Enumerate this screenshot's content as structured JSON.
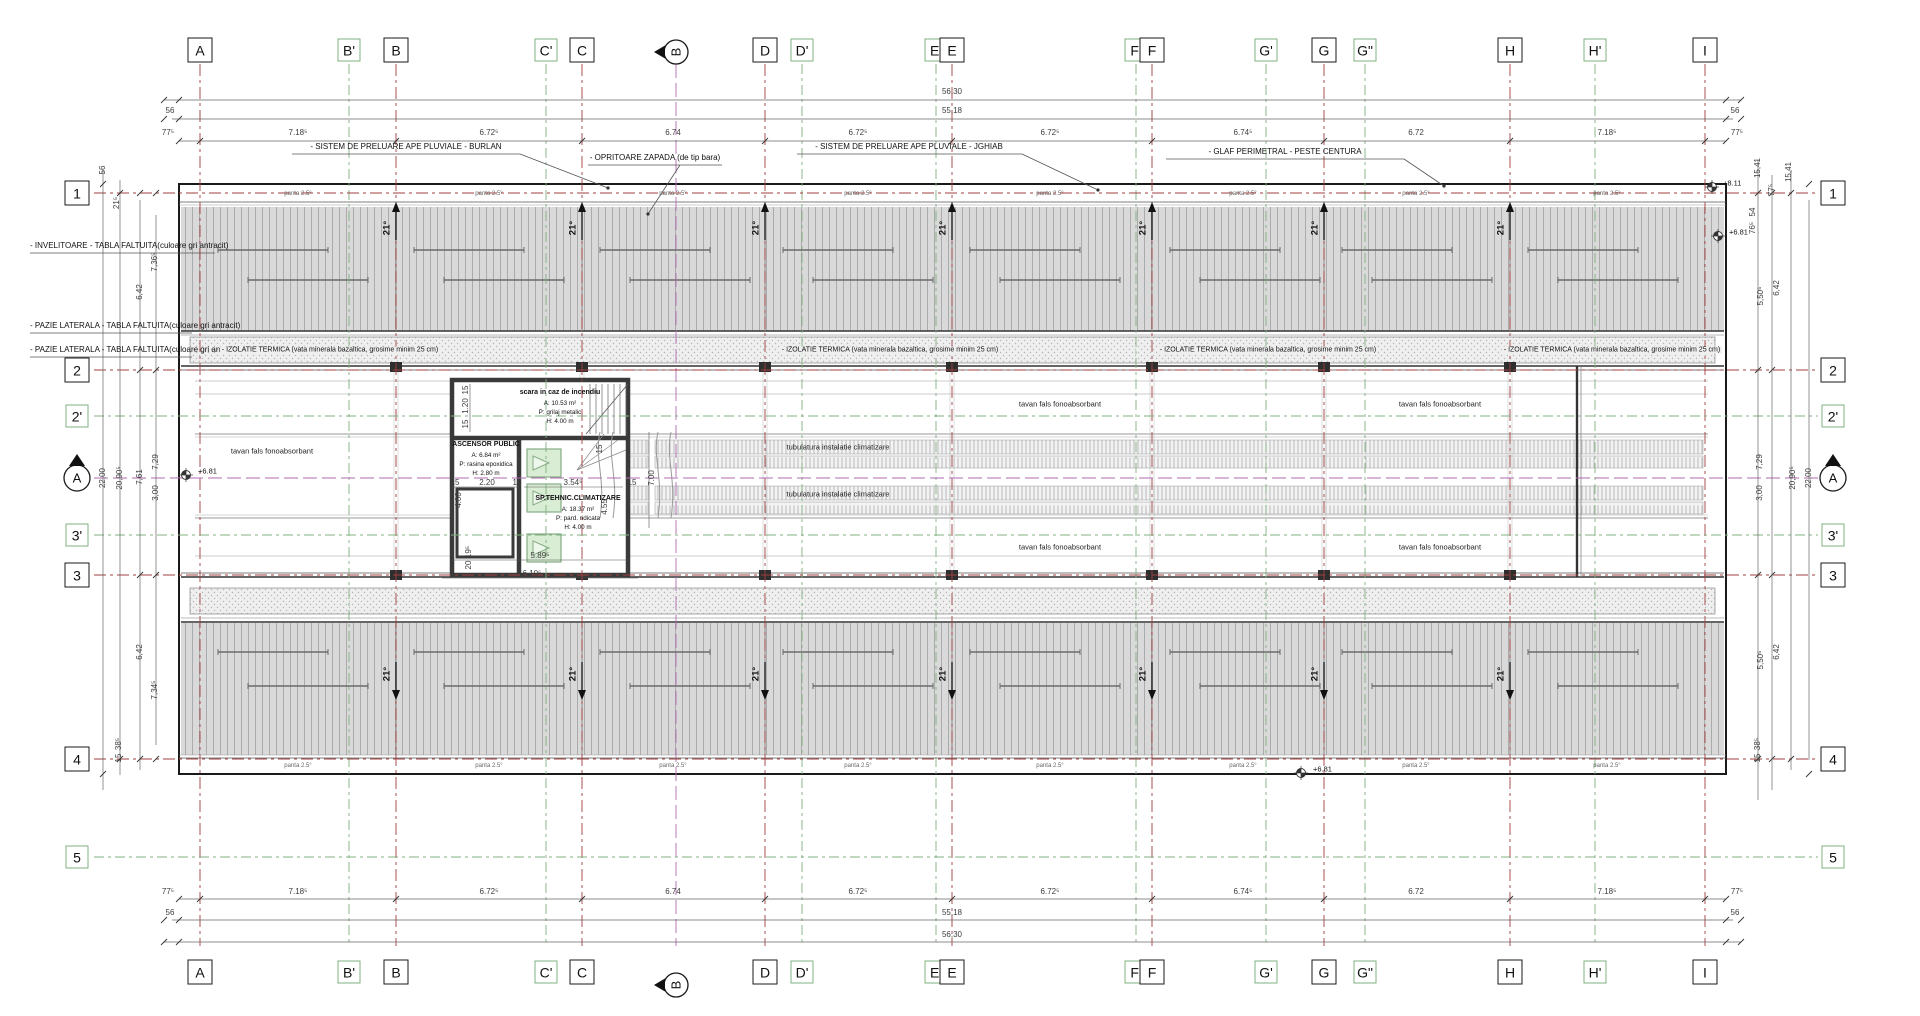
{
  "colors": {
    "grid_main": "#a04040",
    "grid_prime": "#7fb07f",
    "grid_section": "#b06ab0",
    "roof_fill": "#d9d9d9",
    "roof_seam": "#a6a6a6",
    "insul_fill": "#efefef",
    "wall": "#3a3a3a",
    "dim": "#555555",
    "hvac_fill": "#d9ecd4",
    "hvac_border": "#86ac86"
  },
  "grid_top": [
    {
      "label": "A",
      "x": 200,
      "kind": "main"
    },
    {
      "label": "B'",
      "x": 349,
      "kind": "prime"
    },
    {
      "label": "B",
      "x": 396,
      "kind": "main"
    },
    {
      "label": "C'",
      "x": 546,
      "kind": "prime"
    },
    {
      "label": "C",
      "x": 582,
      "kind": "main"
    },
    {
      "label": "B",
      "x": 676,
      "kind": "section"
    },
    {
      "label": "D",
      "x": 765,
      "kind": "main"
    },
    {
      "label": "D'",
      "x": 802,
      "kind": "prime"
    },
    {
      "label": "E'",
      "x": 936,
      "kind": "prime"
    },
    {
      "label": "E",
      "x": 952,
      "kind": "main"
    },
    {
      "label": "F'",
      "x": 1136,
      "kind": "prime"
    },
    {
      "label": "F",
      "x": 1152,
      "kind": "main"
    },
    {
      "label": "G'",
      "x": 1266,
      "kind": "prime"
    },
    {
      "label": "G",
      "x": 1324,
      "kind": "main"
    },
    {
      "label": "G\"",
      "x": 1365,
      "kind": "prime"
    },
    {
      "label": "H",
      "x": 1510,
      "kind": "main"
    },
    {
      "label": "H'",
      "x": 1595,
      "kind": "prime"
    },
    {
      "label": "I",
      "x": 1705,
      "kind": "main"
    }
  ],
  "grid_bottom": [
    {
      "label": "A",
      "x": 200,
      "kind": "main"
    },
    {
      "label": "B'",
      "x": 349,
      "kind": "prime"
    },
    {
      "label": "B",
      "x": 396,
      "kind": "main"
    },
    {
      "label": "C'",
      "x": 546,
      "kind": "prime"
    },
    {
      "label": "C",
      "x": 582,
      "kind": "main"
    },
    {
      "label": "B",
      "x": 676,
      "kind": "section"
    },
    {
      "label": "D",
      "x": 765,
      "kind": "main"
    },
    {
      "label": "D'",
      "x": 802,
      "kind": "prime"
    },
    {
      "label": "E'",
      "x": 936,
      "kind": "prime"
    },
    {
      "label": "E",
      "x": 952,
      "kind": "main"
    },
    {
      "label": "F'",
      "x": 1136,
      "kind": "prime"
    },
    {
      "label": "F",
      "x": 1152,
      "kind": "main"
    },
    {
      "label": "G'",
      "x": 1266,
      "kind": "prime"
    },
    {
      "label": "G",
      "x": 1324,
      "kind": "main"
    },
    {
      "label": "G\"",
      "x": 1365,
      "kind": "prime"
    },
    {
      "label": "H",
      "x": 1510,
      "kind": "main"
    },
    {
      "label": "H'",
      "x": 1595,
      "kind": "prime"
    },
    {
      "label": "I",
      "x": 1705,
      "kind": "main"
    }
  ],
  "rows_left": [
    {
      "label": "1",
      "y": 193,
      "kind": "main"
    },
    {
      "label": "2",
      "y": 370,
      "kind": "main"
    },
    {
      "label": "2'",
      "y": 416,
      "kind": "prime"
    },
    {
      "label": "A",
      "y": 478,
      "kind": "section"
    },
    {
      "label": "3'",
      "y": 535,
      "kind": "prime"
    },
    {
      "label": "3",
      "y": 575,
      "kind": "main"
    },
    {
      "label": "4",
      "y": 759,
      "kind": "main"
    },
    {
      "label": "5",
      "y": 857,
      "kind": "prime"
    }
  ],
  "rows_right": [
    {
      "label": "1",
      "y": 193,
      "kind": "main"
    },
    {
      "label": "2",
      "y": 370,
      "kind": "main"
    },
    {
      "label": "2'",
      "y": 416,
      "kind": "prime"
    },
    {
      "label": "A",
      "y": 478,
      "kind": "section"
    },
    {
      "label": "3'",
      "y": 535,
      "kind": "prime"
    },
    {
      "label": "3",
      "y": 575,
      "kind": "main"
    },
    {
      "label": "4",
      "y": 759,
      "kind": "main"
    },
    {
      "label": "5",
      "y": 857,
      "kind": "prime"
    }
  ],
  "dim_texts": [
    {
      "t": "56,30",
      "x": 952,
      "y": 92
    },
    {
      "t": "55,18",
      "x": 952,
      "y": 111
    },
    {
      "t": "56",
      "x": 170,
      "y": 111
    },
    {
      "t": "56",
      "x": 1735,
      "y": 111
    },
    {
      "t": "77⁵",
      "x": 168,
      "y": 133
    },
    {
      "t": "7.18⁵",
      "x": 298,
      "y": 133
    },
    {
      "t": "6.72⁵",
      "x": 489,
      "y": 133
    },
    {
      "t": "6.74",
      "x": 673,
      "y": 133
    },
    {
      "t": "6.72⁵",
      "x": 858,
      "y": 133
    },
    {
      "t": "6.72⁵",
      "x": 1050,
      "y": 133
    },
    {
      "t": "6.74⁵",
      "x": 1243,
      "y": 133
    },
    {
      "t": "6.72",
      "x": 1416,
      "y": 133
    },
    {
      "t": "7.18⁵",
      "x": 1607,
      "y": 133
    },
    {
      "t": "77⁵",
      "x": 1737,
      "y": 133
    },
    {
      "t": "77⁵",
      "x": 168,
      "y": 892
    },
    {
      "t": "7.18⁵",
      "x": 298,
      "y": 892
    },
    {
      "t": "6.72⁵",
      "x": 489,
      "y": 892
    },
    {
      "t": "6.74",
      "x": 673,
      "y": 892
    },
    {
      "t": "6.72⁵",
      "x": 858,
      "y": 892
    },
    {
      "t": "6.72⁵",
      "x": 1050,
      "y": 892
    },
    {
      "t": "6.74⁵",
      "x": 1243,
      "y": 892
    },
    {
      "t": "6.72",
      "x": 1416,
      "y": 892
    },
    {
      "t": "7.18⁵",
      "x": 1607,
      "y": 892
    },
    {
      "t": "77⁵",
      "x": 1737,
      "y": 892
    },
    {
      "t": "56",
      "x": 170,
      "y": 913
    },
    {
      "t": "55,18",
      "x": 952,
      "y": 913
    },
    {
      "t": "56",
      "x": 1735,
      "y": 913
    },
    {
      "t": "56,30",
      "x": 952,
      "y": 935
    },
    {
      "t": "56",
      "x": 103,
      "y": 170,
      "r": 1
    },
    {
      "t": "21⁵",
      "x": 117,
      "y": 203,
      "r": 1
    },
    {
      "t": "7,36⁵",
      "x": 155,
      "y": 262,
      "r": 1
    },
    {
      "t": "6,42",
      "x": 140,
      "y": 292,
      "r": 1
    },
    {
      "t": "22,00",
      "x": 103,
      "y": 478,
      "r": 1
    },
    {
      "t": "20,90⁵",
      "x": 120,
      "y": 478,
      "r": 1
    },
    {
      "t": "7,61",
      "x": 140,
      "y": 477,
      "r": 1
    },
    {
      "t": "7,29",
      "x": 156,
      "y": 462,
      "r": 1
    },
    {
      "t": "3,00",
      "x": 156,
      "y": 493,
      "r": 1
    },
    {
      "t": "6,42",
      "x": 140,
      "y": 652,
      "r": 1
    },
    {
      "t": "7,34⁵",
      "x": 155,
      "y": 690,
      "r": 1
    },
    {
      "t": "38⁵",
      "x": 119,
      "y": 744,
      "r": 1
    },
    {
      "t": "15",
      "x": 119,
      "y": 758,
      "r": 1
    },
    {
      "t": "15,41",
      "x": 1758,
      "y": 168,
      "r": 1
    },
    {
      "t": "77⁵",
      "x": 1772,
      "y": 190,
      "r": 1
    },
    {
      "t": "15,41",
      "x": 1789,
      "y": 172,
      "r": 1
    },
    {
      "t": "54",
      "x": 1753,
      "y": 212,
      "r": 1
    },
    {
      "t": "76⁵",
      "x": 1753,
      "y": 228,
      "r": 1
    },
    {
      "t": "5,50⁵",
      "x": 1761,
      "y": 296,
      "r": 1
    },
    {
      "t": "6,42",
      "x": 1777,
      "y": 288,
      "r": 1
    },
    {
      "t": "7,29",
      "x": 1760,
      "y": 462,
      "r": 1
    },
    {
      "t": "3,00",
      "x": 1760,
      "y": 493,
      "r": 1
    },
    {
      "t": "20,90⁵",
      "x": 1793,
      "y": 478,
      "r": 1
    },
    {
      "t": "22,00",
      "x": 1809,
      "y": 478,
      "r": 1
    },
    {
      "t": "5,50⁵",
      "x": 1761,
      "y": 660,
      "r": 1
    },
    {
      "t": "6,42",
      "x": 1777,
      "y": 652,
      "r": 1
    },
    {
      "t": "38⁵",
      "x": 1758,
      "y": 744,
      "r": 1
    },
    {
      "t": "15",
      "x": 1758,
      "y": 758,
      "r": 1
    },
    {
      "t": "15",
      "x": 466,
      "y": 390,
      "r": 1
    },
    {
      "t": "1.20",
      "x": 466,
      "y": 406,
      "r": 1
    },
    {
      "t": "15",
      "x": 466,
      "y": 424,
      "r": 1
    },
    {
      "t": "4.00",
      "x": 459,
      "y": 500,
      "r": 1
    },
    {
      "t": "15",
      "x": 455,
      "y": 483
    },
    {
      "t": "2.20",
      "x": 487,
      "y": 483
    },
    {
      "t": "15",
      "x": 517,
      "y": 483
    },
    {
      "t": "3.54⁵",
      "x": 573,
      "y": 483
    },
    {
      "t": "15",
      "x": 632,
      "y": 483
    },
    {
      "t": "15",
      "x": 600,
      "y": 449,
      "r": 1
    },
    {
      "t": "7.00",
      "x": 652,
      "y": 478,
      "r": 1
    },
    {
      "t": "4.55",
      "x": 605,
      "y": 507,
      "r": 1
    },
    {
      "t": "5.89⁵",
      "x": 540,
      "y": 556
    },
    {
      "t": "6.10⁵",
      "x": 532,
      "y": 574
    },
    {
      "t": "19⁵",
      "x": 469,
      "y": 552,
      "r": 1
    },
    {
      "t": "20",
      "x": 469,
      "y": 565,
      "r": 1
    }
  ],
  "zone_texts": [
    {
      "t": "tavan fals fonoabsorbant",
      "x": 272,
      "y": 451
    },
    {
      "t": "tavan fals fonoabsorbant",
      "x": 1060,
      "y": 404
    },
    {
      "t": "tavan fals fonoabsorbant",
      "x": 1440,
      "y": 404
    },
    {
      "t": "tavan fals fonoabsorbant",
      "x": 1060,
      "y": 547
    },
    {
      "t": "tavan fals fonoabsorbant",
      "x": 1440,
      "y": 547
    },
    {
      "t": "tubulatura instalatie climatizare",
      "x": 838,
      "y": 447
    },
    {
      "t": "tubulatura instalatie climatizare",
      "x": 838,
      "y": 494
    }
  ],
  "core": {
    "rooms": [
      {
        "name": "fire-stair",
        "x": 560,
        "y": 388,
        "lines": [
          "scara in caz de incendiu",
          "A: 10.53 m²",
          "P: grilaj metalic",
          "H: 4.00 m"
        ]
      },
      {
        "name": "public-elevator",
        "x": 486,
        "y": 440,
        "lines": [
          "ASCENSOR PUBLIC",
          "A: 6.84 m²",
          "P: rasina epoxidica",
          "H: 2.80 m"
        ]
      },
      {
        "name": "hvac-room",
        "x": 578,
        "y": 494,
        "lines": [
          "SP.TEHNIC.CLIMATIZARE",
          "A: 18.37 m²",
          "P: pard. ridicata",
          "H: 4.00 m"
        ]
      }
    ]
  },
  "callouts": [
    {
      "t": "- SISTEM DE PRELUARE APE PLUVIALE - BURLAN",
      "x": 406,
      "y": 147,
      "align": "c",
      "ul": [
        292,
        154,
        520,
        154
      ],
      "ld": [
        520,
        154,
        608,
        188
      ]
    },
    {
      "t": "- SISTEM DE PRELUARE APE PLUVIALE - JGHIAB",
      "x": 909,
      "y": 147,
      "align": "c",
      "ul": [
        797,
        154,
        1022,
        154
      ],
      "ld": [
        1022,
        154,
        1098,
        190
      ]
    },
    {
      "t": "- OPRITOARE ZAPADA (de tip bara)",
      "x": 655,
      "y": 158,
      "align": "c",
      "ul": [
        588,
        165,
        722,
        165
      ],
      "ld": [
        680,
        165,
        648,
        214
      ]
    },
    {
      "t": "- GLAF PERIMETRAL - PESTE CENTURA",
      "x": 1285,
      "y": 152,
      "align": "c",
      "ul": [
        1166,
        159,
        1404,
        159
      ],
      "ld": [
        1404,
        159,
        1444,
        186
      ]
    },
    {
      "t": "- INVELITOARE - TABLA FALTUITA(culoare gri antracit)",
      "x": 30,
      "y": 246,
      "align": "l",
      "ul": [
        30,
        253,
        215,
        253
      ]
    },
    {
      "t": "- PAZIE LATERALA - TABLA FALTUITA(culoare gri antracit)",
      "x": 30,
      "y": 326,
      "align": "l",
      "ul": [
        30,
        333,
        192,
        333
      ]
    },
    {
      "t": "- PAZIE LATERALA - TABLA FALTUITA(culoare gri antracit)",
      "x": 30,
      "y": 350,
      "align": "l",
      "ul": [
        30,
        357,
        192,
        357
      ]
    }
  ],
  "insulation": {
    "label": "- IZOLATIE TERMICA (vata minerala bazaltica, grosime minim 25 cm)",
    "xs": [
      330,
      890,
      1268,
      1612
    ],
    "y": 350
  },
  "roof": {
    "slope": "21°",
    "panta": "panta 2.5°",
    "arrow_xs": [
      396,
      582,
      765,
      952,
      1152,
      1324,
      1510
    ],
    "panta_xs": [
      298,
      489,
      673,
      858,
      1050,
      1243,
      1416,
      1607
    ],
    "panta_top_y": 194,
    "panta_bottom_y": 766
  },
  "elevations": [
    {
      "t": "+8.11",
      "x": 1723,
      "y": 183,
      "sx": 1712,
      "sy": 187
    },
    {
      "t": "+6.81",
      "x": 1729,
      "y": 232,
      "sx": 1718,
      "sy": 236
    },
    {
      "t": "+6.81",
      "x": 198,
      "y": 471,
      "sx": 186,
      "sy": 475
    },
    {
      "t": "+6.81",
      "x": 1313,
      "y": 769,
      "sx": 1301,
      "sy": 773
    }
  ]
}
